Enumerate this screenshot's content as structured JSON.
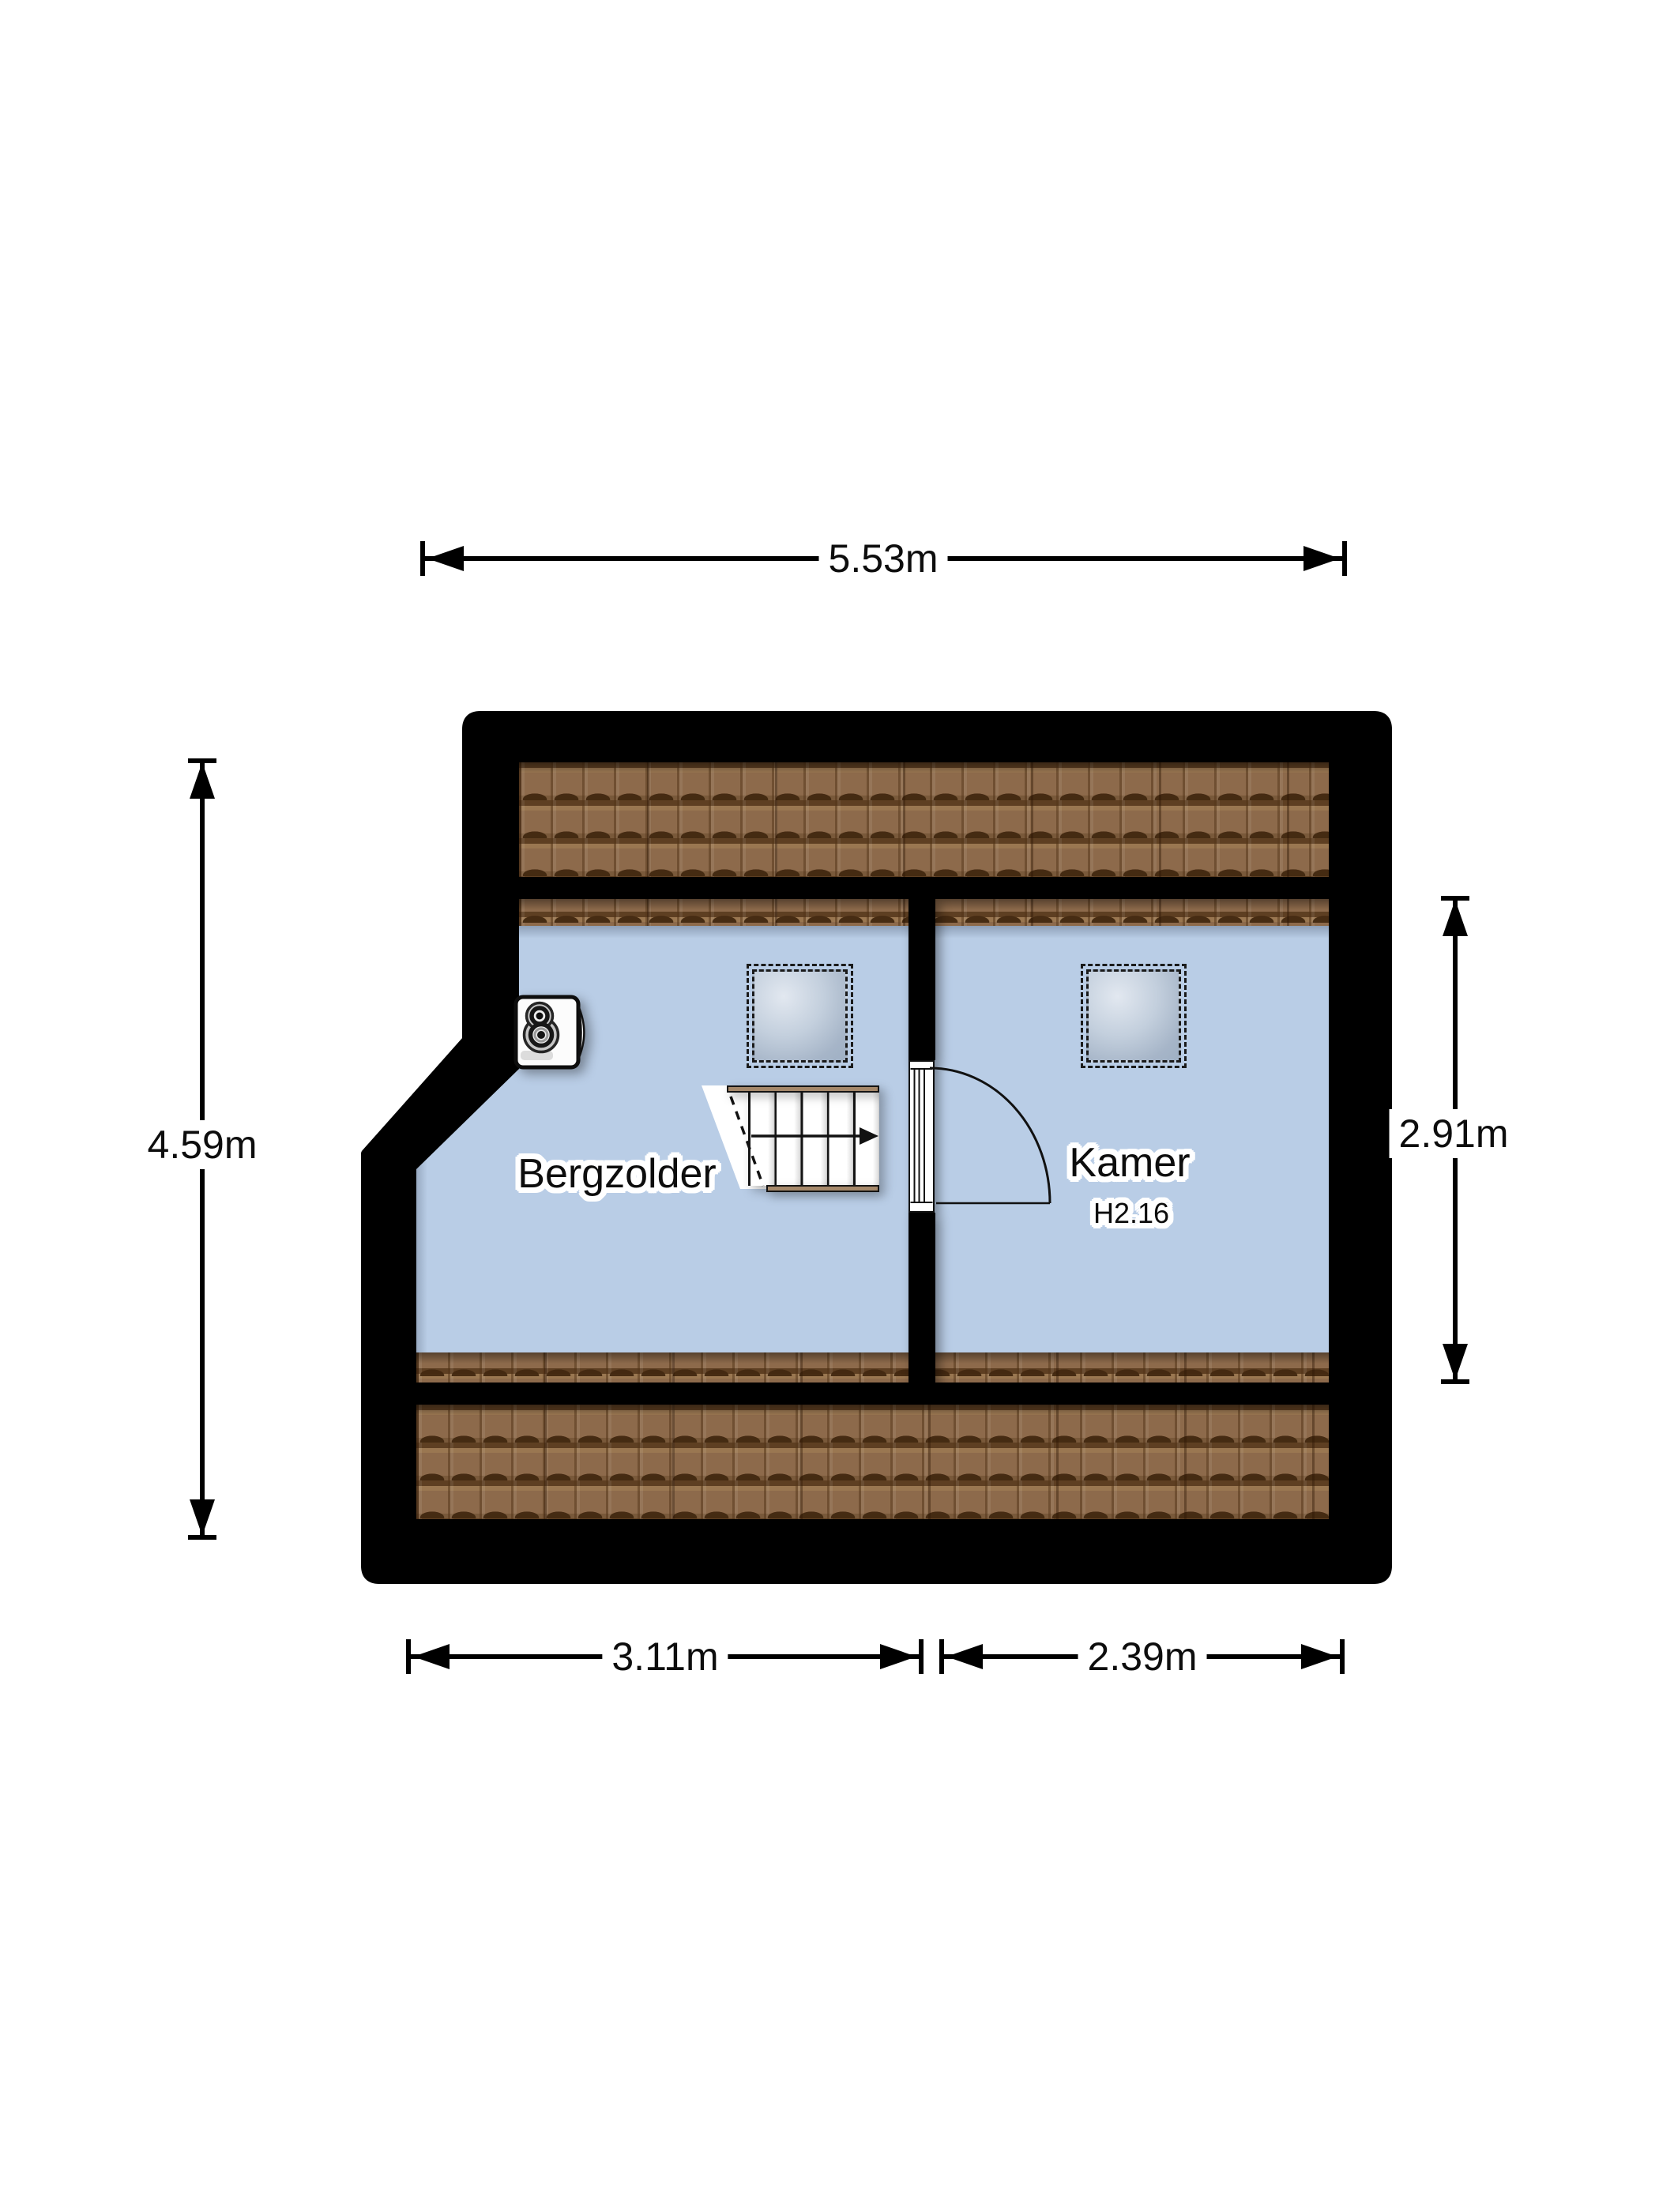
{
  "plan": {
    "type": "attic floor plan",
    "rooms": [
      {
        "name": "Bergzolder"
      },
      {
        "name": "Kamer",
        "code": "H2.16"
      }
    ],
    "dimensions": {
      "top": "5.53m",
      "left": "4.59m",
      "right": "2.91m",
      "bottom_left": "3.11m",
      "bottom_right": "2.39m"
    },
    "colors": {
      "wall": "#000000",
      "floor": "#b9cde6",
      "roof_tiles": "#8d6a4b",
      "stair_trim": "#a5886a",
      "skylight_glass_light": "#e2e8f0",
      "skylight_glass_dark": "#9fb0c4",
      "background": "#ffffff"
    },
    "icons": [
      "mechanical-ventilation-icon",
      "skylight-icon",
      "stairs-direction-arrow-icon",
      "door-swing-icon"
    ]
  }
}
